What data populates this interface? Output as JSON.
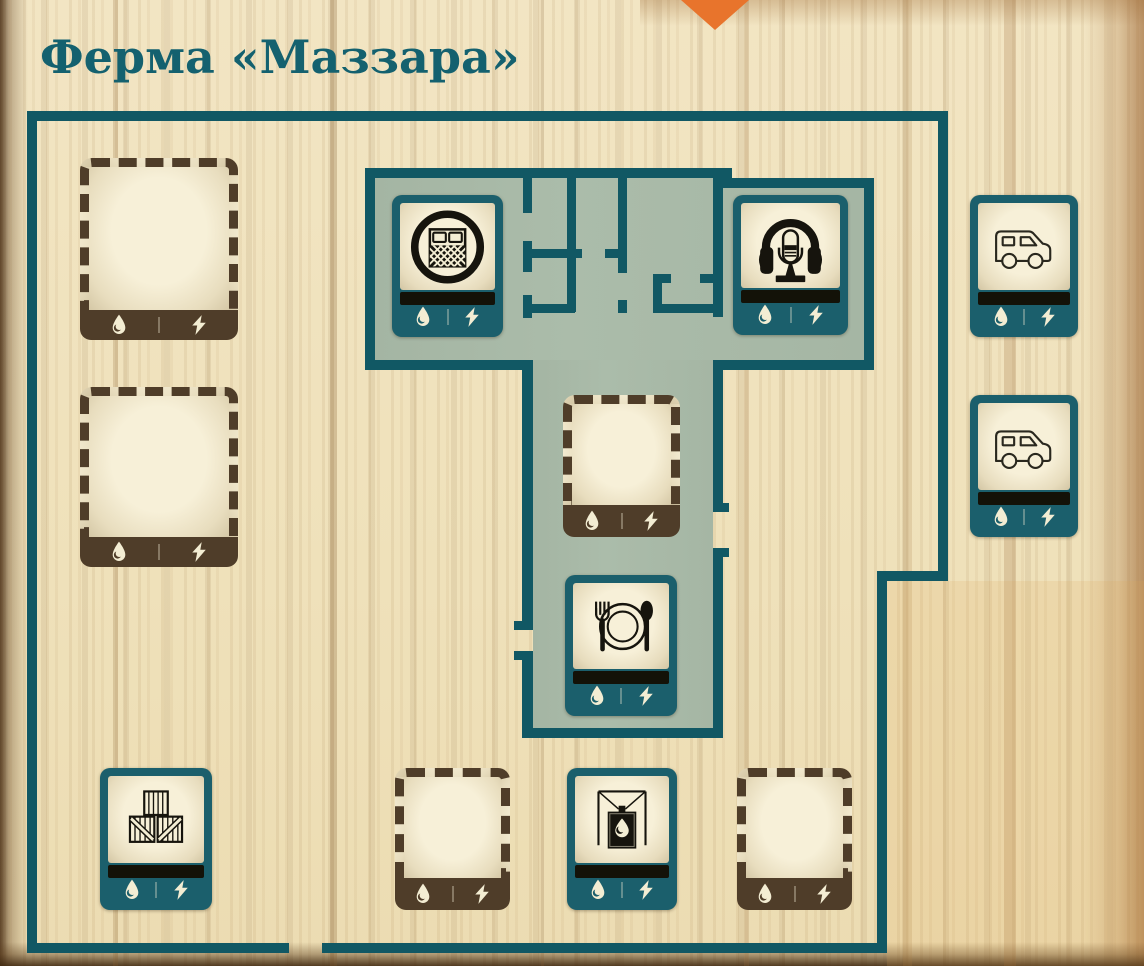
{
  "title": "Ферма «Маззара»",
  "marker": {
    "shape": "orange-diamond",
    "color": "#e8742c"
  },
  "colors": {
    "wall_teal": "#115864",
    "tile_teal": "#1b5f6c",
    "room_sage": "#a8b9a7",
    "slot_brown": "#4f3d29",
    "paper_cream": "#f1e4c1",
    "icon_ink": "#16140d"
  },
  "utilities": [
    "water",
    "power"
  ],
  "utility_icons": {
    "water": "water-drop-icon",
    "power": "lightning-bolt-icon"
  },
  "slots": [
    {
      "id": "slot-empty-left-top",
      "kind": "empty",
      "size": "large",
      "x": 80,
      "y": 158,
      "w": 158,
      "h": 182
    },
    {
      "id": "slot-empty-left-middle",
      "kind": "empty",
      "size": "large",
      "x": 80,
      "y": 387,
      "w": 158,
      "h": 180
    },
    {
      "id": "room-bedroom",
      "kind": "room",
      "icon": "bed-icon",
      "x": 392,
      "y": 195,
      "w": 111,
      "h": 142
    },
    {
      "id": "room-radio",
      "kind": "room",
      "icon": "radio-icon",
      "x": 733,
      "y": 195,
      "w": 115,
      "h": 140
    },
    {
      "id": "slot-empty-corridor",
      "kind": "empty",
      "size": "small",
      "x": 563,
      "y": 395,
      "w": 117,
      "h": 142
    },
    {
      "id": "room-dining",
      "kind": "room",
      "icon": "dining-icon",
      "x": 565,
      "y": 575,
      "w": 112,
      "h": 141
    },
    {
      "id": "room-storage-crates",
      "kind": "room",
      "icon": "crates-icon",
      "x": 100,
      "y": 768,
      "w": 112,
      "h": 142
    },
    {
      "id": "slot-empty-bottom-left",
      "kind": "empty",
      "size": "small",
      "x": 395,
      "y": 768,
      "w": 115,
      "h": 142
    },
    {
      "id": "room-water-collector",
      "kind": "room",
      "icon": "water-collector-icon",
      "x": 567,
      "y": 768,
      "w": 110,
      "h": 142
    },
    {
      "id": "slot-empty-bottom-right",
      "kind": "empty",
      "size": "small",
      "x": 737,
      "y": 768,
      "w": 115,
      "h": 142
    },
    {
      "id": "vehicle-van-top",
      "kind": "room",
      "icon": "van-icon",
      "x": 970,
      "y": 195,
      "w": 108,
      "h": 142
    },
    {
      "id": "vehicle-van-bottom",
      "kind": "room",
      "icon": "van-icon",
      "x": 970,
      "y": 395,
      "w": 108,
      "h": 142
    }
  ]
}
